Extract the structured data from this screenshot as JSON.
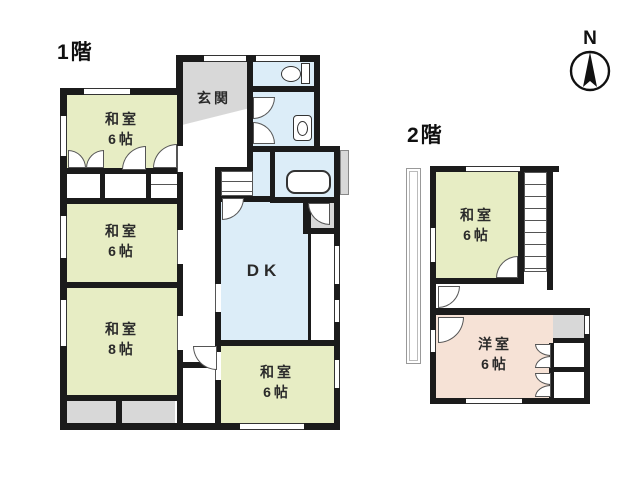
{
  "compass": {
    "label": "N"
  },
  "floor1": {
    "label": "1階",
    "entrance_label": "玄関",
    "dk_label": "DK",
    "rooms": [
      {
        "name": "和室",
        "size": "6帖"
      },
      {
        "name": "和室",
        "size": "6帖"
      },
      {
        "name": "和室",
        "size": "8帖"
      },
      {
        "name": "和室",
        "size": "6帖"
      }
    ]
  },
  "floor2": {
    "label": "2階",
    "rooms": [
      {
        "name": "和室",
        "size": "6帖"
      },
      {
        "name": "洋室",
        "size": "6帖"
      }
    ]
  },
  "colors": {
    "wall": "#1b1b1b",
    "tatami_room": "#e7edc4",
    "wet_area": "#dcedf8",
    "western_room": "#f6e2d6",
    "entrance_gray": "#d8d8d8"
  }
}
